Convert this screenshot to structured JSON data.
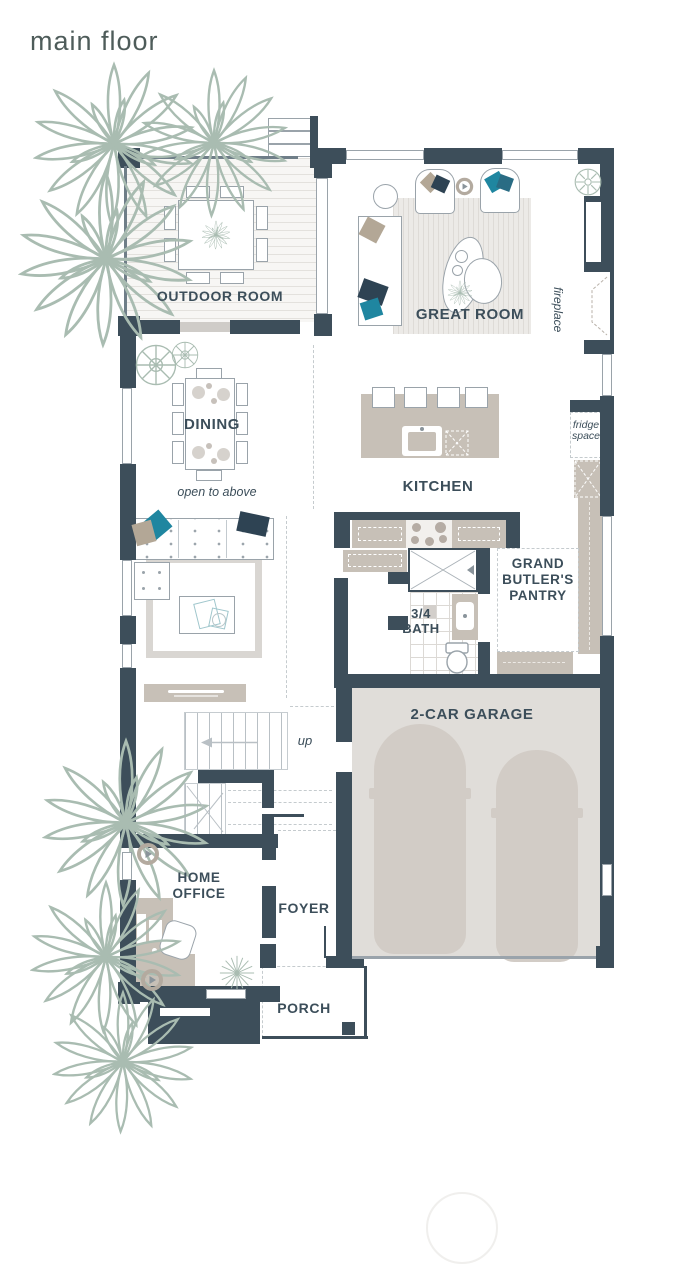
{
  "title": "main floor",
  "labels": {
    "outdoor_room": "OUTDOOR ROOM",
    "great_room": "GREAT ROOM",
    "fireplace": "fireplace",
    "dining": "DINING",
    "open_to_above": "open to above",
    "kitchen": "KITCHEN",
    "fridge_space": "fridge space",
    "butlers_pantry": "GRAND BUTLER'S PANTRY",
    "bath": "3/4 BATH",
    "stairs_up": "up",
    "garage": "2-CAR GARAGE",
    "home_office": "HOME OFFICE",
    "foyer": "FOYER",
    "porch": "PORCH"
  },
  "colors": {
    "wall": "#3d4e5a",
    "label": "#3c4e5a",
    "title": "#4e5c5a",
    "sage": "#a9bcb1",
    "taupe": "#c7c0b7",
    "taupe_dark": "#b3aa9f",
    "teal": "#1f86a0",
    "teal_dark": "#2a6c84",
    "navy": "#2e4353",
    "tan": "#b3a796",
    "line": "#9aa3aa",
    "thin": "#6f7e88",
    "dash": "#c5cbce",
    "door": "#cfccc8",
    "floor": "#f7f6f4",
    "rug": "#eceae7",
    "rug_stripe": "#dedbd7",
    "garage_floor": "#e0ddd9",
    "car": "#d2ccc6",
    "watermark": "#f0efed"
  },
  "icons": [
    "plant-icon",
    "shrub-icon",
    "ceiling-fan-icon",
    "speaker-icon",
    "sunburst-icon",
    "shower-icon",
    "toilet-icon",
    "sink-icon",
    "cooktop-icon",
    "dishwasher-icon",
    "up-arrow-icon",
    "fireplace-icon"
  ]
}
